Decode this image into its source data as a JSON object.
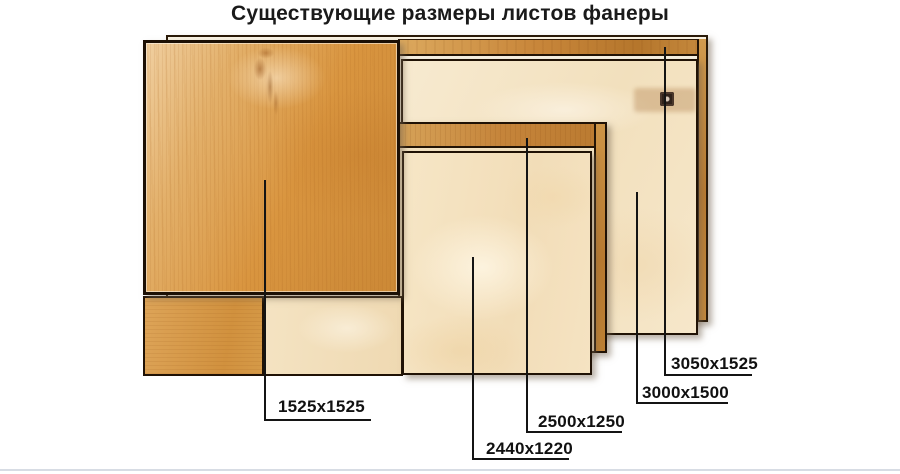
{
  "title": "Существующие размеры листов фанеры",
  "sheets": [
    {
      "label": "1525x1525"
    },
    {
      "label": "2440x1220"
    },
    {
      "label": "2500x1250"
    },
    {
      "label": "3000x1500"
    },
    {
      "label": "3050x1525"
    }
  ],
  "colors": {
    "background": "#ffffff",
    "title_text": "#1a1a1a",
    "sheet_border": "#201205",
    "leader_line": "#141414",
    "wood_dark": "#d08d3a",
    "wood_medium": "#d9a054",
    "wood_light_cream": "#f6e6c6",
    "band_orange": "#c5843a",
    "footer_bar": "#d7dce4"
  }
}
